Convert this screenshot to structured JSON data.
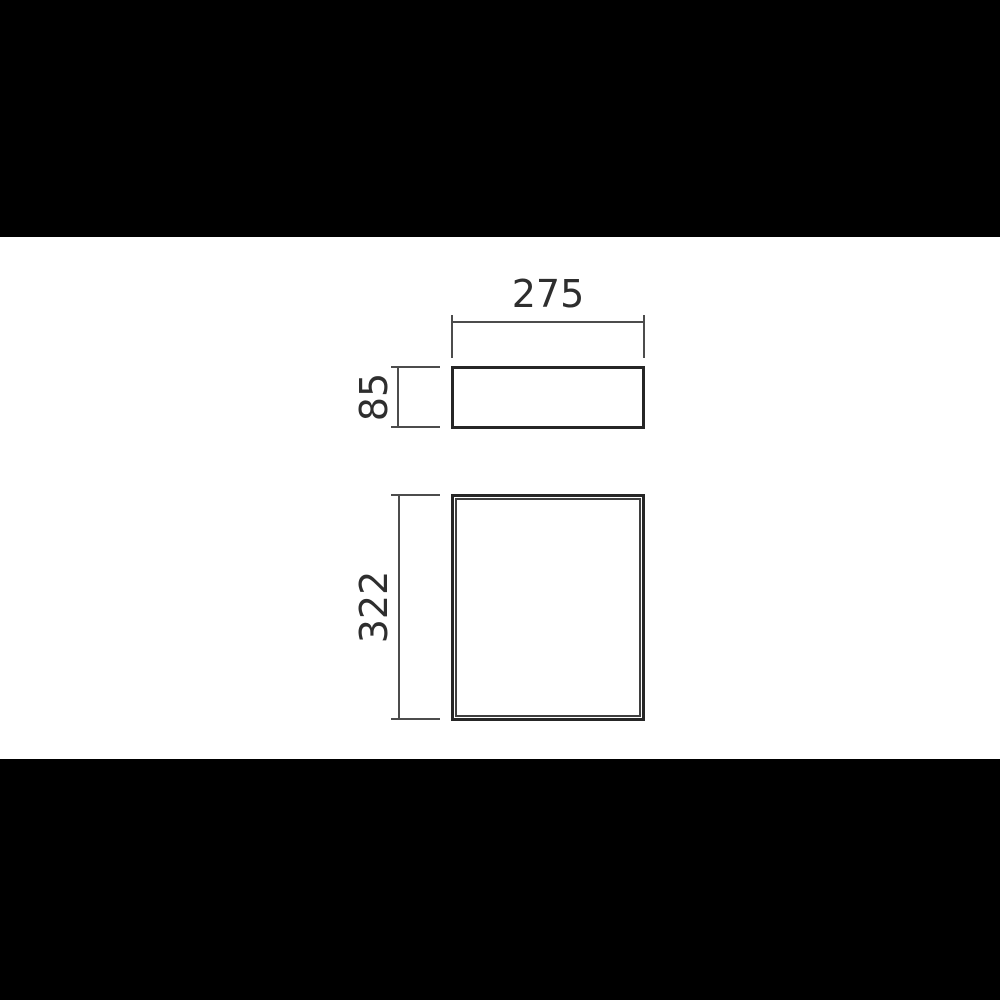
{
  "scene": {
    "description": "Two-view product dimension drawing on white band with black letterbox bars",
    "colors": {
      "letterbox": "#000000",
      "canvas": "#ffffff",
      "dimension_line": "#4c4c4c",
      "outline": "#262626",
      "text": "#2e2e2e"
    },
    "top_view": {
      "width_label": "275",
      "height_label": "85"
    },
    "front_view": {
      "height_label": "322"
    }
  }
}
